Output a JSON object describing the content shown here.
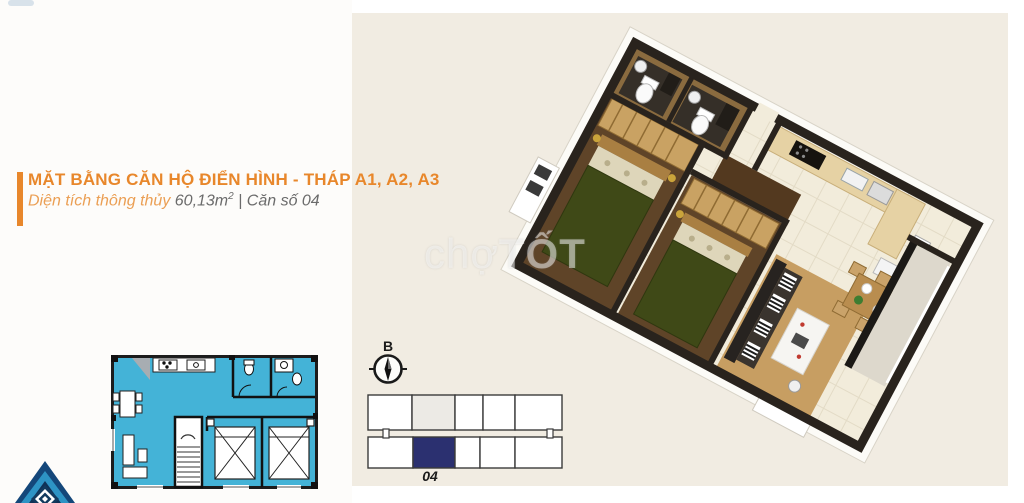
{
  "colors": {
    "accent": "#e8872b",
    "accent_light": "#eb9f54",
    "text_gray": "#6b6b6b",
    "beige": "#f1ece2",
    "cyan": "#44b3d7",
    "navy": "#2b3070",
    "wall": "#29231d",
    "tile": "#f2ecdb",
    "wood": "#c9a263",
    "wood_dark": "#5f4428",
    "bed_green": "#3f4917"
  },
  "header": {
    "title": "MẶT BẰNG CĂN HỘ ĐIỂN HÌNH - THÁP A1, A2, A3",
    "subtitle_prefix": "Diện tích thông thủy",
    "subtitle_area": "60,13m",
    "subtitle_sup": "2",
    "subtitle_sep": "|",
    "subtitle_unit": "Căn số 04"
  },
  "watermark": {
    "part1": "chợ",
    "part2": "TỐT"
  },
  "compass": {
    "label": "B"
  },
  "block_diagram": {
    "unit_label": "04",
    "border": "#3b3b3b",
    "top_row": {
      "y": 395,
      "h": 35,
      "cells": [
        {
          "x": 368,
          "w": 44,
          "fill": "#ffffff"
        },
        {
          "x": 412,
          "w": 43,
          "fill": "#eceae5"
        },
        {
          "x": 455,
          "w": 28,
          "fill": "#ffffff"
        },
        {
          "x": 483,
          "w": 32,
          "fill": "#ffffff"
        },
        {
          "x": 515,
          "w": 47,
          "fill": "#ffffff"
        }
      ]
    },
    "bottom_row": {
      "y": 437,
      "h": 31,
      "cells": [
        {
          "x": 368,
          "w": 45,
          "fill": "#ffffff"
        },
        {
          "x": 413,
          "w": 42,
          "fill": "#2b3070"
        },
        {
          "x": 455,
          "w": 25,
          "fill": "#ffffff"
        },
        {
          "x": 480,
          "w": 35,
          "fill": "#ffffff"
        },
        {
          "x": 515,
          "w": 47,
          "fill": "#ffffff"
        }
      ]
    },
    "connectors": [
      {
        "x": 386
      },
      {
        "x": 550
      }
    ]
  }
}
